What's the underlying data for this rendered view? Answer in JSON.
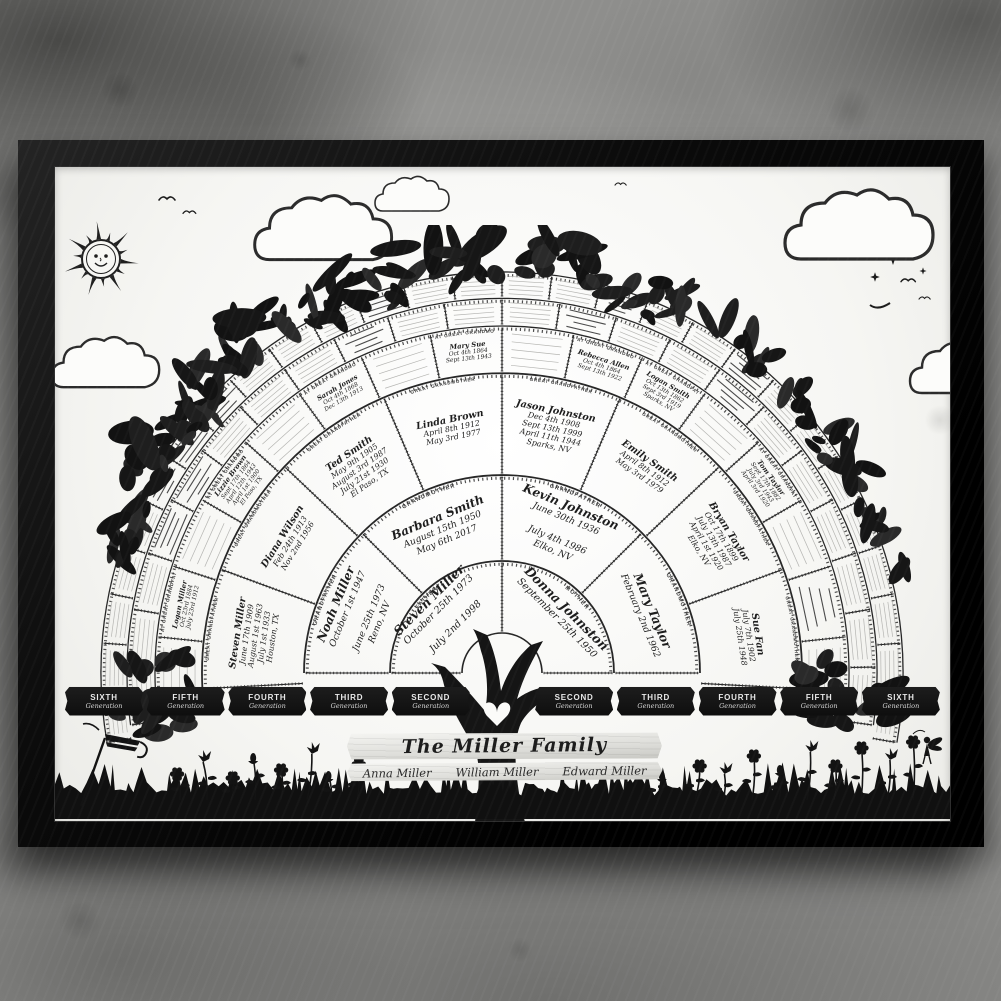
{
  "scene": {
    "description": "Framed family tree fan chart poster hanging on a grunge concrete wall",
    "wall_color": "#8e8e8c",
    "frame_color": "#0d0d0d",
    "poster_color": "#fbfbf9",
    "ink_color": "#1c1c1c"
  },
  "plaque": {
    "title": "The Miller Family",
    "names": [
      "Anna Miller",
      "William Miller",
      "Edward Miller"
    ]
  },
  "banners": [
    {
      "word": "SIXTH",
      "sub": "Generation"
    },
    {
      "word": "FIFTH",
      "sub": "Generation"
    },
    {
      "word": "FOURTH",
      "sub": "Generation"
    },
    {
      "word": "THIRD",
      "sub": "Generation"
    },
    {
      "word": "SECOND",
      "sub": "Generation"
    },
    {
      "word": "SECOND",
      "sub": "Generation"
    },
    {
      "word": "THIRD",
      "sub": "Generation"
    },
    {
      "word": "FOURTH",
      "sub": "Generation"
    },
    {
      "word": "FIFTH",
      "sub": "Generation"
    },
    {
      "word": "SIXTH",
      "sub": "Generation"
    }
  ],
  "fan": {
    "ring_segments": [
      2,
      4,
      8,
      16,
      22,
      28
    ],
    "center_icon": "heart-icon",
    "people": [
      {
        "ring": 1,
        "seg": 0,
        "role": "FATHER",
        "name": "Steven Miller",
        "lines": [
          "October 25th 1973",
          "",
          "July 2nd 1998"
        ]
      },
      {
        "ring": 1,
        "seg": 1,
        "role": "MOTHER",
        "name": "Donna Johnston",
        "lines": [
          "September 25th 1950"
        ]
      },
      {
        "ring": 2,
        "seg": 0,
        "role": "GRANDFATHER",
        "name": "Noah Miller",
        "lines": [
          "October 1st 1947",
          "",
          "June 25th 1973",
          "Reno, NV"
        ]
      },
      {
        "ring": 2,
        "seg": 1,
        "role": "GRANDMOTHER",
        "name": "Barbara Smith",
        "lines": [
          "August 15th 1950",
          "May 6th 2017"
        ]
      },
      {
        "ring": 2,
        "seg": 2,
        "role": "GRANDFATHER",
        "name": "Kevin Johnston",
        "lines": [
          "June 30th 1936",
          "",
          "July 4th 1986",
          "Elko, NV"
        ]
      },
      {
        "ring": 2,
        "seg": 3,
        "role": "GRANDMOTHER",
        "name": "Mary Taylor",
        "lines": [
          "February 2nd 1962"
        ]
      },
      {
        "ring": 3,
        "seg": 0,
        "role": "GREAT GRANDFATHER",
        "name": "Steven Miller",
        "lines": [
          "June 17th 1909",
          "August 1st 1963",
          "July 1st 1933",
          "Houston, TX"
        ]
      },
      {
        "ring": 3,
        "seg": 1,
        "role": "GREAT GRANDMOTHER",
        "name": "Diana Wilson",
        "lines": [
          "Feb 24th 1913",
          "Nov 2nd 1956"
        ]
      },
      {
        "ring": 3,
        "seg": 2,
        "role": "GREAT GRANDFATHER",
        "name": "Ted Smith",
        "lines": [
          "May 9th 1905",
          "August 3rd 1987",
          "July 21st 1930",
          "El Paso, TX"
        ]
      },
      {
        "ring": 3,
        "seg": 3,
        "role": "GREAT GRANDMOTHER",
        "name": "Linda Brown",
        "lines": [
          "April 8th 1912",
          "May 3rd 1977"
        ]
      },
      {
        "ring": 3,
        "seg": 4,
        "role": "GREAT GRANDFATHER",
        "name": "Jason Johnston",
        "lines": [
          "Dec 4th 1908",
          "Sept 13th 1999",
          "April 11th 1944",
          "Sparks, NV"
        ]
      },
      {
        "ring": 3,
        "seg": 5,
        "role": "GREAT GRANDMOTHER",
        "name": "Emily Smith",
        "lines": [
          "April 8th 1912",
          "May 3rd 1979"
        ]
      },
      {
        "ring": 3,
        "seg": 6,
        "role": "GREAT GRANDFATHER",
        "name": "Bryan Taylor",
        "lines": [
          "Oct 17th 1899",
          "July 13th 1987",
          "April 1st 1920",
          "Elko, NV"
        ]
      },
      {
        "ring": 3,
        "seg": 7,
        "role": "GREAT GRANDMOTHER",
        "name": "Sue Fan",
        "lines": [
          "July 7th 1902",
          "July 25th 1948"
        ]
      },
      {
        "ring": 4,
        "seg": 1,
        "role": "GREAT GREAT GRANDFATHER",
        "name": "Logan Miller",
        "lines": [
          "Oct 23rd 1884",
          "July 23rd 1912"
        ]
      },
      {
        "ring": 4,
        "seg": 3,
        "role": "GREAT GREAT GRANDMOTHER",
        "name": "Lizzie Brown",
        "lines": [
          "Sept 17th 1864",
          "April 12th 1943",
          "April 1st 1900",
          "El Paso, TX"
        ]
      },
      {
        "ring": 4,
        "seg": 5,
        "role": "GREAT GREAT GRANDMOTHER",
        "name": "Sarah Jones",
        "lines": [
          "Oct 4th 1868",
          "Dec 13th 1913"
        ]
      },
      {
        "ring": 4,
        "seg": 7,
        "role": "GREAT GREAT GRANDMOTHER",
        "name": "Mary Sue",
        "lines": [
          "Oct 4th 1864",
          "Sept 13th 1943"
        ]
      },
      {
        "ring": 4,
        "seg": 9,
        "role": "GREAT GREAT GRANDMOTHER",
        "name": "Rebecca Allen",
        "lines": [
          "Oct 4th 1864",
          "Sept 13th 1922"
        ]
      },
      {
        "ring": 4,
        "seg": 10,
        "role": "GREAT GREAT GRANDFATHER",
        "name": "Logan Smith",
        "lines": [
          "Oct 13th 1862",
          "Sept 3rd 1919",
          "Sparks, NV"
        ]
      },
      {
        "ring": 4,
        "seg": 12,
        "role": "GREAT GREAT GRANDFATHER",
        "name": "Tom Taylor",
        "lines": [
          "Sept 17th 1882",
          "July 3rd 1943",
          "April 3rd 1920"
        ]
      }
    ],
    "decorative_filled": {
      "ring4": [
        14
      ],
      "ring5": [
        3,
        4,
        8,
        12,
        15
      ],
      "ring6": [
        5,
        6,
        7,
        11,
        16,
        19
      ]
    }
  },
  "decor": {
    "sun": "sun-icon",
    "moon": "crescent-moon-icon",
    "clouds": "cloud-icon",
    "birds": "bird-icon",
    "sparkles": "sparkle-icon",
    "foliage": "leaf-canopy",
    "tree": "tree-trunk-with-heart",
    "grass": "grass-silhouette",
    "flowers": "flower-silhouettes",
    "fairy": "fairy-icon",
    "windsock": "windsock-icon"
  }
}
